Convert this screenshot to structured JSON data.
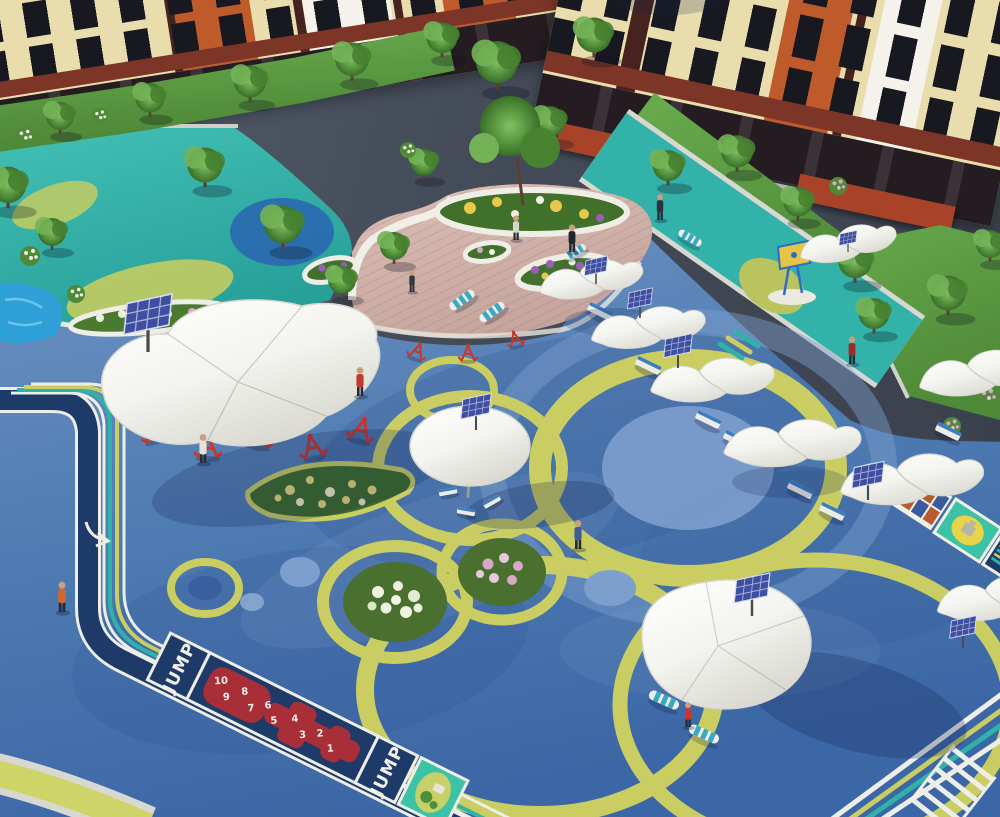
{
  "meta": {
    "type": "3d-architectural-rendering",
    "subject": "Aerial view of a residential courtyard playground with blue rubber surfacing, shade canopies, solar panels and fitness equipment",
    "view": "aerial isometric"
  },
  "hopscotch": {
    "label_start": "JUMP",
    "label_end": "JUMP",
    "numbers": [
      "10",
      "9",
      "8",
      "7",
      "6",
      "5",
      "4",
      "3",
      "2",
      "1"
    ]
  },
  "colors": {
    "surface_blue": "#4f7cb2",
    "surface_blue_dark": "#33589b",
    "surface_teal": "#2fb3a8",
    "ring_yellow_green": "#c9cd62",
    "circle_light_blue": "#7d9fce",
    "track_navy": "#1d3a69",
    "line_white": "#eeeee8",
    "hopscotch_red": "#a82f38",
    "game_panel_green": "#3cc2a5",
    "canopy_white": "#f6f6f2",
    "solar_panel": "#3e4fa2",
    "equipment_red": "#c8362c",
    "bench_blue": "#3a7ec0",
    "building_cream": "#eaddad",
    "building_orange": "#bf5a2b",
    "building_maroon": "#46231f",
    "awning_red": "#a8432a",
    "asphalt_gray": "#454c59",
    "lawn_green": "#5a9a40",
    "deck_wood": "#cfb1a8",
    "water_blue": "#2f9fd8",
    "flower_yellow": "#e8d87a",
    "flower_pink": "#d9a8c8",
    "flower_white": "#eef2e2",
    "flower_purple": "#9a5fb8"
  },
  "inventory": {
    "apartment_buildings": 2,
    "shade_canopies": 11,
    "solar_panels": 9,
    "people": 10,
    "fitness_machines": 9,
    "hopscotch_numbers": 10,
    "trees": 22
  }
}
